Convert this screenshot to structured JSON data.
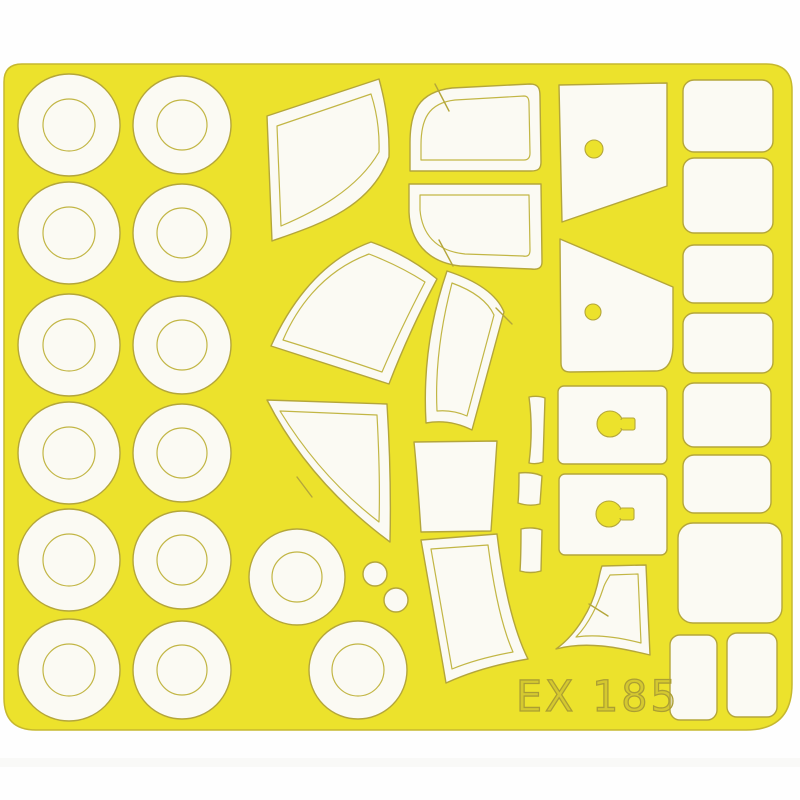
{
  "product": {
    "code": "EX 185"
  },
  "colors": {
    "background": "#fefefe",
    "sheet": "#ece22c",
    "sheet_edge": "#c6b82e",
    "mask": "#fbfaf3",
    "cut_line": "#b4a63a",
    "etch_line": "#c2b645",
    "code_text": "#ab9e33"
  },
  "masks_summary": {
    "ring_wheel_masks": 14,
    "small_dot_masks": 2,
    "canopy_masks": 16,
    "rectangle_masks": 9
  },
  "wheel_grid": {
    "columns": [
      {
        "x": 69,
        "outer_r": 51,
        "inner_r": 26
      },
      {
        "x": 182,
        "outer_r": 49,
        "inner_r": 25
      }
    ],
    "rows_y": [
      125,
      233,
      345,
      453,
      560,
      670
    ]
  },
  "extra_rings": [
    {
      "x": 297,
      "y": 577,
      "outer_r": 48,
      "inner_r": 25
    },
    {
      "x": 358,
      "y": 670,
      "outer_r": 49,
      "inner_r": 26
    }
  ],
  "dots": [
    {
      "x": 375,
      "y": 574,
      "r": 12
    },
    {
      "x": 396,
      "y": 600,
      "r": 12
    }
  ],
  "rect_masks": [
    {
      "x": 683,
      "y": 80,
      "w": 90,
      "h": 72,
      "rx": 11
    },
    {
      "x": 683,
      "y": 158,
      "w": 90,
      "h": 75,
      "rx": 11
    },
    {
      "x": 683,
      "y": 245,
      "w": 90,
      "h": 58,
      "rx": 11
    },
    {
      "x": 683,
      "y": 313,
      "w": 90,
      "h": 60,
      "rx": 11
    },
    {
      "x": 683,
      "y": 383,
      "w": 88,
      "h": 64,
      "rx": 11
    },
    {
      "x": 683,
      "y": 455,
      "w": 88,
      "h": 58,
      "rx": 11
    },
    {
      "x": 678,
      "y": 523,
      "w": 104,
      "h": 100,
      "rx": 15
    },
    {
      "x": 670,
      "y": 635,
      "w": 47,
      "h": 85,
      "rx": 10
    },
    {
      "x": 727,
      "y": 633,
      "w": 50,
      "h": 84,
      "rx": 10
    }
  ]
}
